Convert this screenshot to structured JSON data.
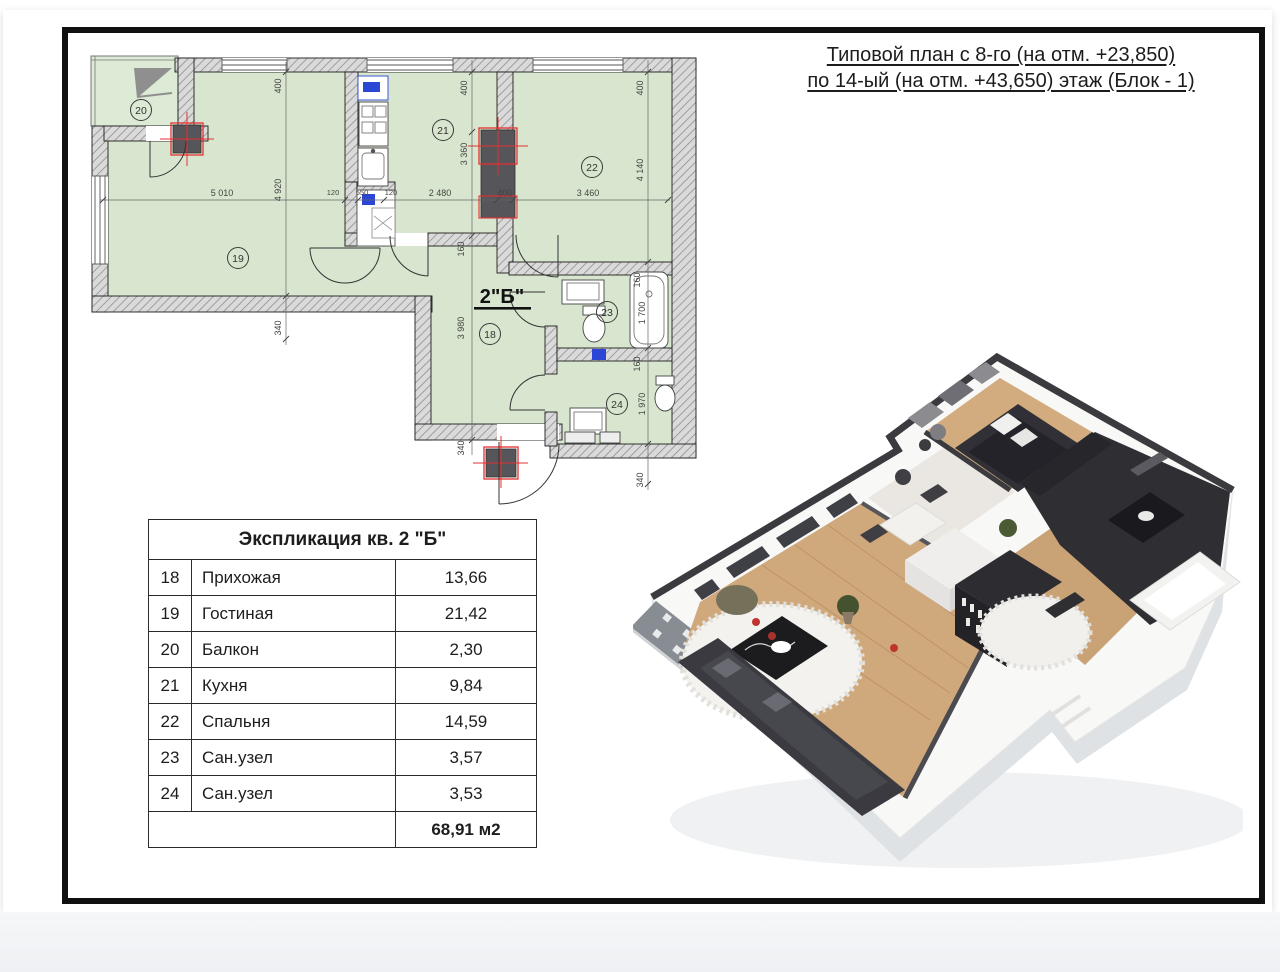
{
  "page": {
    "background": "#ffffff",
    "frame_color": "#101010",
    "bottom_strip": "#eef0f3"
  },
  "header": {
    "line1": "Типовой план с 8-го (на отм. +23,850)",
    "line2": "по 14-ый (на отм. +43,650) этаж (Блок - 1)"
  },
  "floor_plan": {
    "apartment_label": "2\"Б\"",
    "room_labels": [
      "18",
      "19",
      "20",
      "21",
      "22",
      "23",
      "24"
    ],
    "dims_top_chain": [
      "5 010",
      "120",
      "550",
      "120",
      "2 480",
      "400",
      "3 460"
    ],
    "dims_left": [
      "400",
      "4 920",
      "340"
    ],
    "dims_mid": [
      "400",
      "3 360",
      "160",
      "3 980",
      "340"
    ],
    "dims_right": [
      "400",
      "4 140",
      "160",
      "1 700",
      "160",
      "1 970",
      "340"
    ],
    "colors": {
      "room_fill": "#d9e6cf",
      "balcony_fill": "#dcead6",
      "wall_fill": "#dadada",
      "hatch_line": "#8f8f8f",
      "column_red": "#e53030",
      "fixture_blue": "#2b46d4"
    }
  },
  "legend_table": {
    "title": "Экспликация кв. 2 \"Б\"",
    "rows": [
      {
        "num": "18",
        "name": "Прихожая",
        "area": "13,66"
      },
      {
        "num": "19",
        "name": "Гостиная",
        "area": "21,42"
      },
      {
        "num": "20",
        "name": "Балкон",
        "area": "2,30"
      },
      {
        "num": "21",
        "name": "Кухня",
        "area": "9,84"
      },
      {
        "num": "22",
        "name": "Спальня",
        "area": "14,59"
      },
      {
        "num": "23",
        "name": "Сан.узел",
        "area": "3,57"
      },
      {
        "num": "24",
        "name": "Сан.узел",
        "area": "3,53"
      }
    ],
    "total_area": "68,91 м2"
  }
}
